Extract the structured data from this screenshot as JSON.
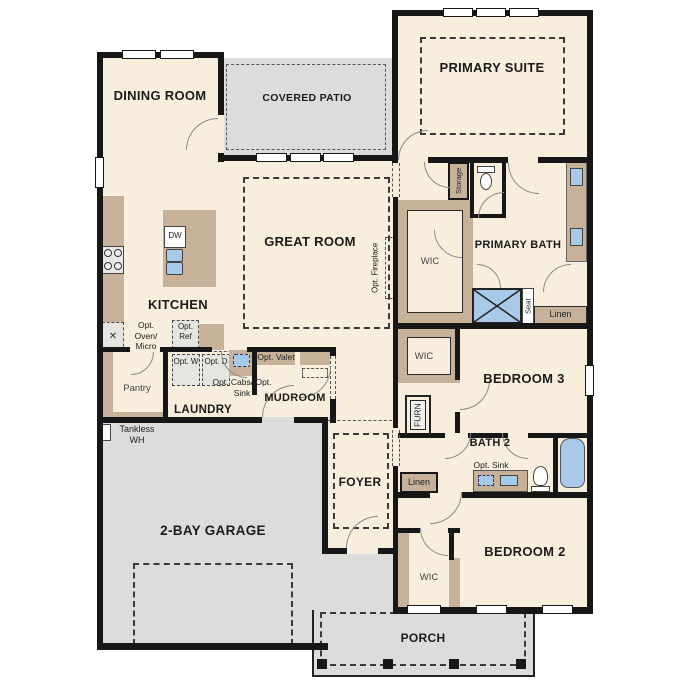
{
  "colors": {
    "floor": "#f7eedd",
    "outdoor": "#dcddda",
    "cabinet_tan": "#c7b299",
    "fixture_blue": "#a9c9e9",
    "wall_black": "#171717"
  },
  "rooms": {
    "dining": {
      "label": "DINING ROOM"
    },
    "covered_patio": {
      "label": "COVERED PATIO"
    },
    "primary_suite": {
      "label": "PRIMARY SUITE"
    },
    "great_room": {
      "label": "GREAT ROOM"
    },
    "kitchen": {
      "label": "KITCHEN"
    },
    "pantry": {
      "label": "Pantry"
    },
    "laundry": {
      "label": "LAUNDRY"
    },
    "mudroom": {
      "label": "MUDROOM"
    },
    "garage": {
      "label": "2-BAY GARAGE"
    },
    "foyer": {
      "label": "FOYER"
    },
    "primary_bath": {
      "label": "PRIMARY BATH"
    },
    "wic_primary": {
      "label": "WIC"
    },
    "wic_hall": {
      "label": "WIC"
    },
    "wic_bedroom2": {
      "label": "WIC"
    },
    "bedroom3": {
      "label": "BEDROOM 3"
    },
    "bath2": {
      "label": "BATH 2"
    },
    "bedroom2": {
      "label": "BEDROOM 2"
    },
    "porch": {
      "label": "PORCH"
    }
  },
  "fixtures": {
    "dishwasher": "DW",
    "opt_oven_micro": "Opt. Oven/ Micro",
    "opt_ref": "Opt. Ref",
    "opt_washer": "Opt. W",
    "opt_dryer": "Opt. D",
    "opt_cabs_sink": "Opt. Cabs/ Opt. Sink",
    "opt_valet": "Opt. Valet",
    "tankless_wh": "Tankless WH",
    "storage": "Storage",
    "seat": "Seat",
    "linen_primary": "Linen",
    "linen_hall": "Linen",
    "furnace": "FURN",
    "opt_fireplace": "Opt. Fireplace",
    "opt_sink_bath2": "Opt. Sink"
  }
}
